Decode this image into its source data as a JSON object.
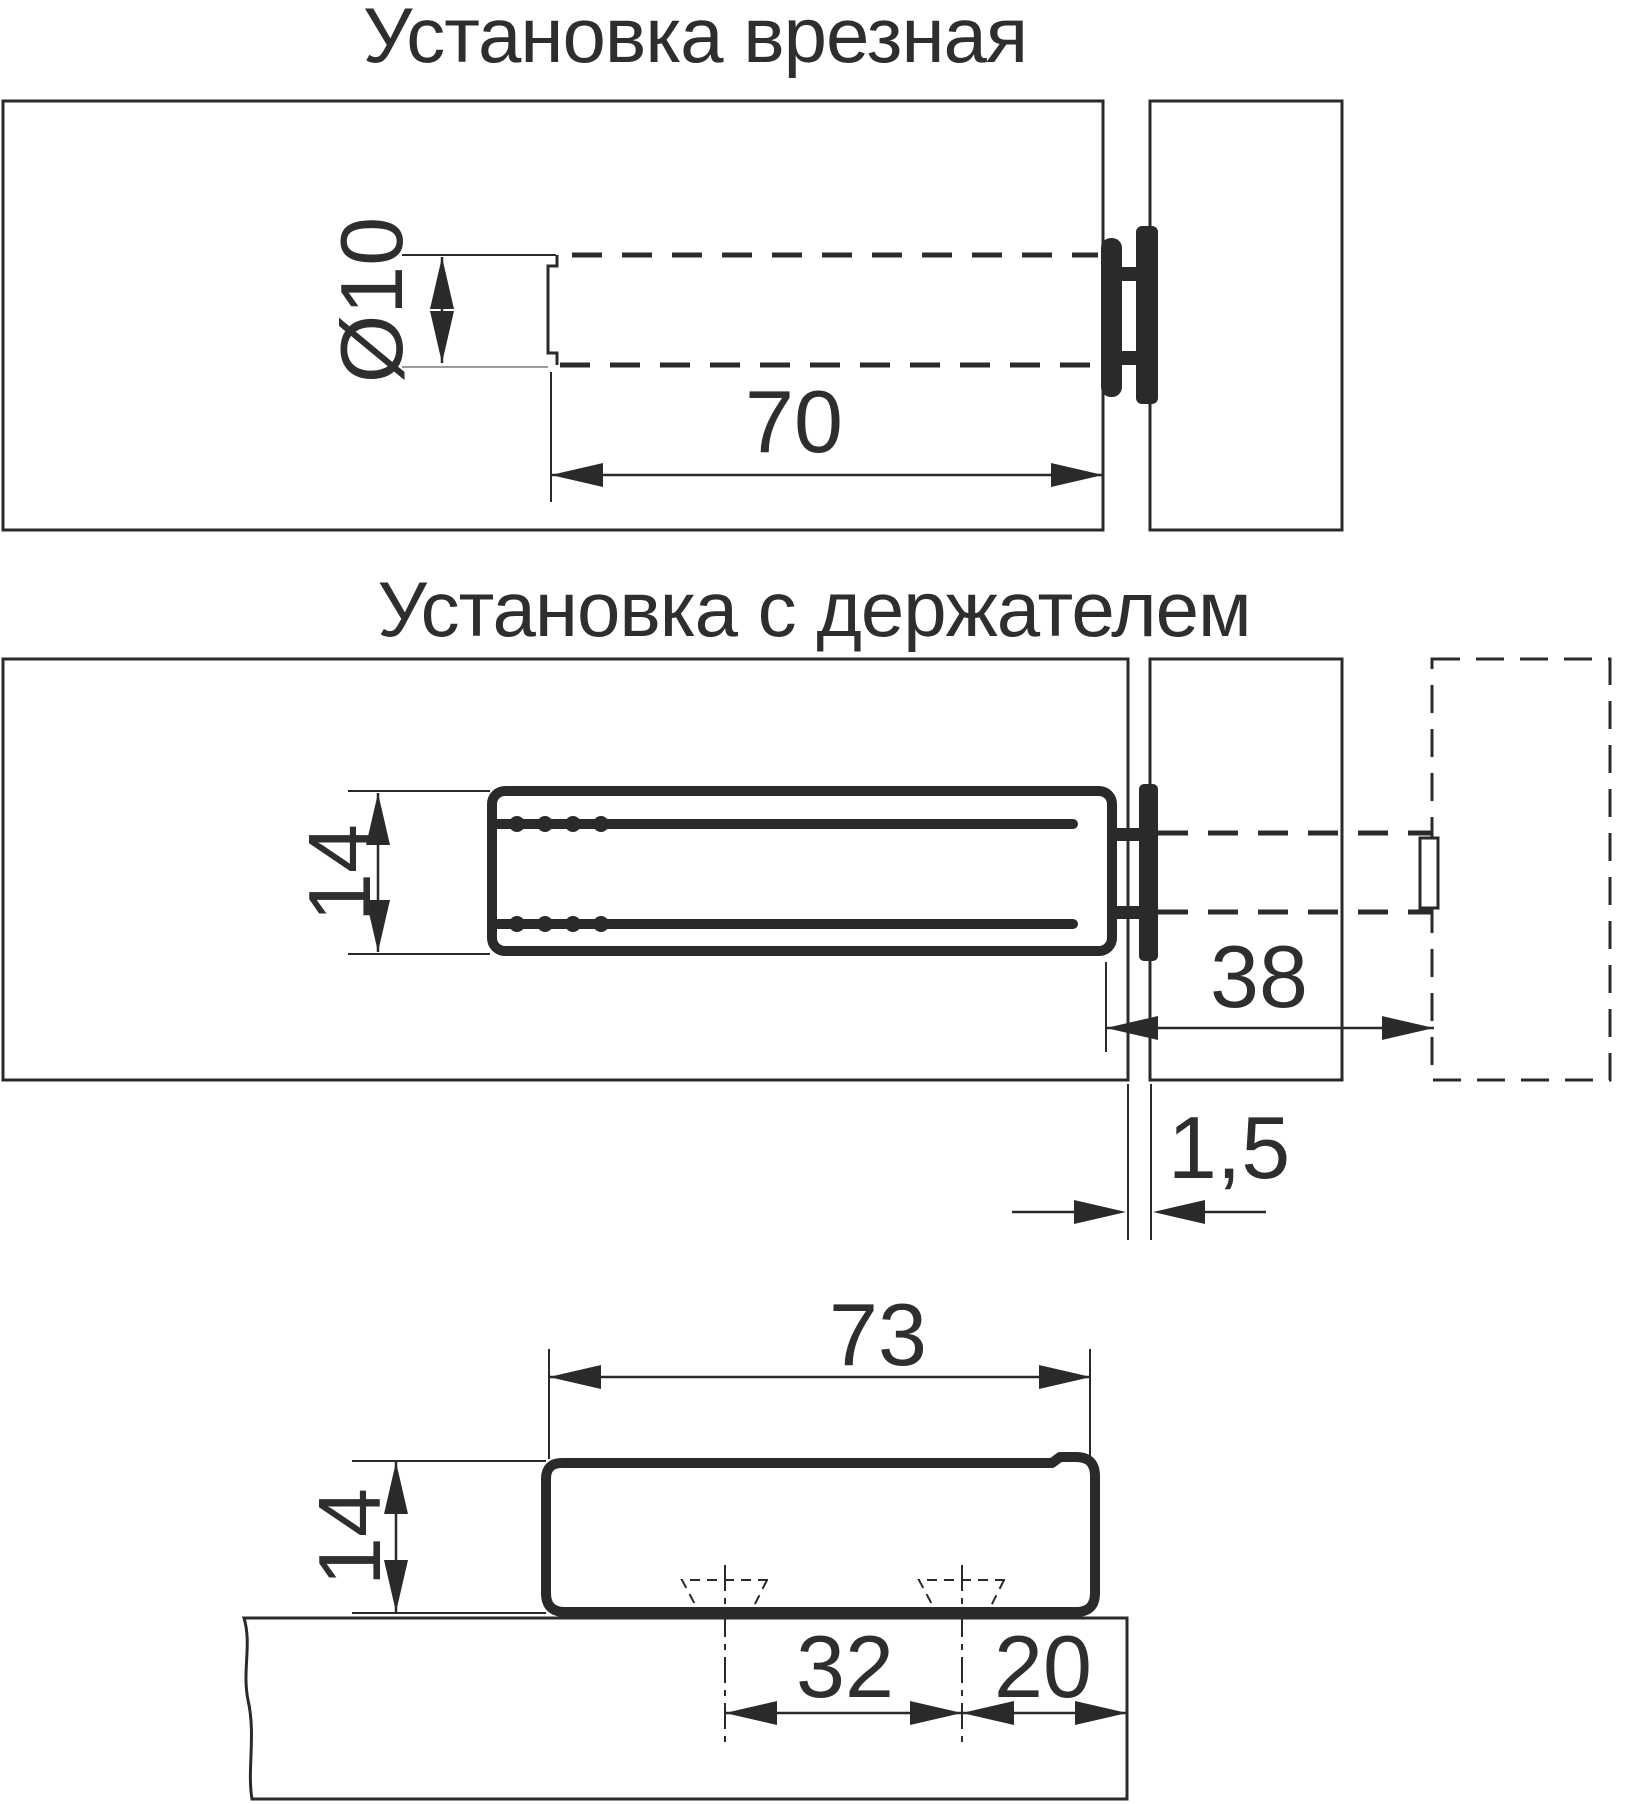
{
  "canvas": {
    "width": 1631,
    "height": 1804,
    "background": "#ffffff",
    "line_color": "#2b2a29",
    "text_color": "#2f2e2d"
  },
  "views": {
    "mortise": {
      "title": "Установка врезная",
      "dims": {
        "hole_diameter": "Ø10",
        "hole_depth": "70"
      }
    },
    "holder": {
      "title": "Установка с держателем",
      "dims": {
        "latch_height": "14",
        "opening_distance": "38",
        "door_gap": "1,5"
      }
    },
    "holder_side": {
      "dims": {
        "length": "73",
        "height": "14",
        "screw_spacing": "32",
        "edge_distance": "20"
      }
    }
  }
}
